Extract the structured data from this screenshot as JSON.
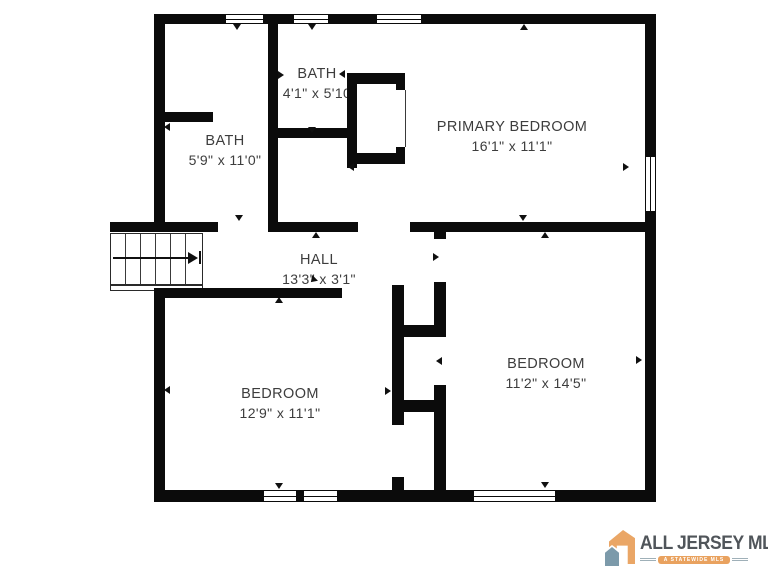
{
  "floor_plan": {
    "rooms": [
      {
        "key": "bath_top",
        "name": "BATH",
        "dims": "4'1\" x 5'10"
      },
      {
        "key": "bath_left",
        "name": "BATH",
        "dims": "5'9\" x 11'0\""
      },
      {
        "key": "primary_bedroom",
        "name": "PRIMARY BEDROOM",
        "dims": "16'1\" x 11'1\""
      },
      {
        "key": "hall",
        "name": "HALL",
        "dims": "13'3\" x 3'1\""
      },
      {
        "key": "bedroom_left",
        "name": "BEDROOM",
        "dims": "12'9\" x 11'1\""
      },
      {
        "key": "bedroom_right",
        "name": "BEDROOM",
        "dims": "11'2\" x 14'5\""
      }
    ]
  },
  "branding": {
    "title": "ALL JERSEY MLS",
    "tagline": "A STATEWIDE MLS"
  },
  "colors": {
    "background": "#ffffff",
    "wall": "#0b0b0b",
    "label_text": "#3d3d3d",
    "logo_orange": "#EAA666",
    "logo_slate": "#7C9AAA",
    "logo_text": "#50555A"
  }
}
